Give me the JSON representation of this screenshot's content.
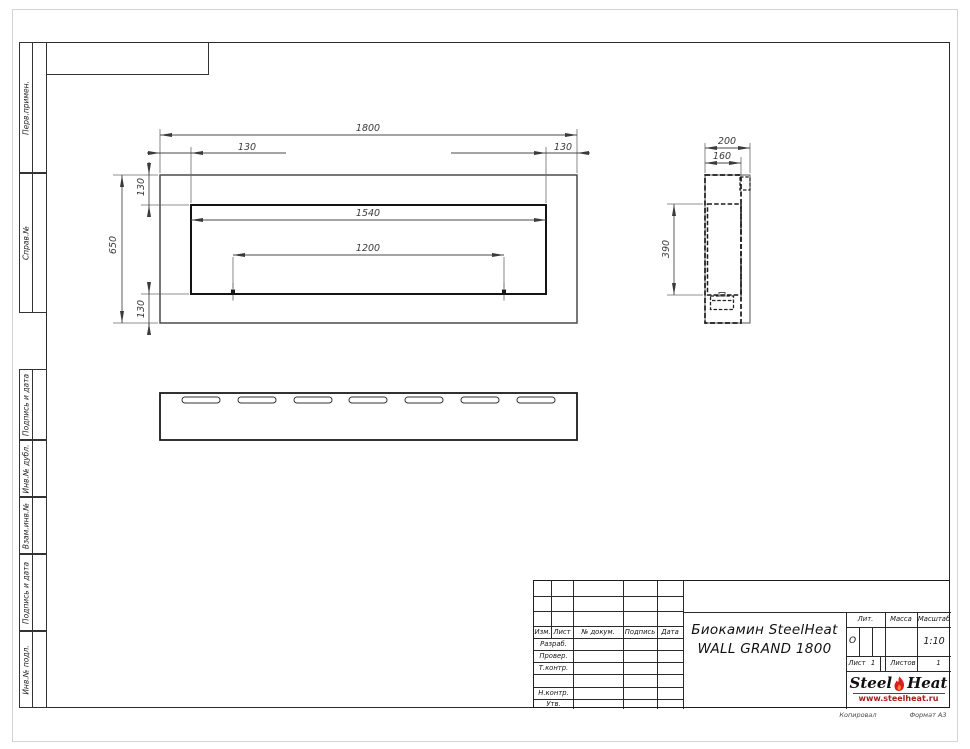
{
  "sheet": {
    "footer_copy": "Копировал",
    "footer_format": "Формат А3"
  },
  "stamps": {
    "upper": [
      {
        "label": "Перв.примен."
      },
      {
        "label": "Справ.№"
      }
    ],
    "lower": [
      {
        "label": "Подпись и дата"
      },
      {
        "label": "Инв.№ дубл."
      },
      {
        "label": "Взам.инв.№"
      },
      {
        "label": "Подпись и дата"
      },
      {
        "label": "Инв.№ подл."
      }
    ]
  },
  "dims": {
    "front_width": "1800",
    "front_height": "650",
    "frame_left": "130",
    "frame_right": "130",
    "frame_top": "130",
    "frame_bottom": "130",
    "opening_width": "1540",
    "burner_length": "1200",
    "depth": "200",
    "body_depth": "160",
    "opening_height": "390"
  },
  "title_block": {
    "header": [
      "Изм.",
      "Лист",
      "№ докум.",
      "Подпись",
      "Дата"
    ],
    "rows": [
      "Разраб.",
      "Провер.",
      "Т.контр.",
      "Н.контр.",
      "Утв."
    ],
    "title_line1": "Биокамин SteelHeat",
    "title_line2": "WALL GRAND 1800",
    "lit_label": "Лит.",
    "lit_value": "О",
    "mass_label": "Масса",
    "scale_label": "Масштаб",
    "scale_value": "1:10",
    "sheet_label": "Лист",
    "sheet_value": "1",
    "sheets_label": "Листов",
    "sheets_value": "1",
    "logo": {
      "steel": "Steel",
      "heat": "Heat",
      "url": "www.steelheat.ru"
    }
  },
  "colors": {
    "accent_red": "#c3161c",
    "line": "#2a2a2a"
  }
}
